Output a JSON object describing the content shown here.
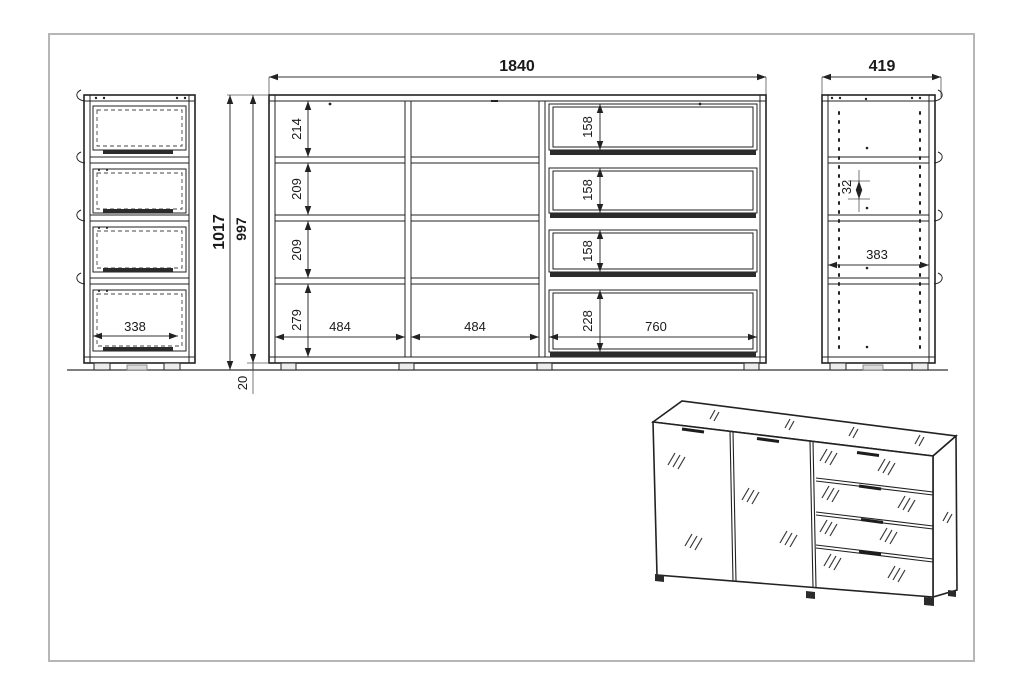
{
  "dimensions": {
    "total_width": "1840",
    "total_depth": "419",
    "total_height": "1017",
    "body_height": "997",
    "plinth_height": "20",
    "row_1": "214",
    "row_2": "209",
    "row_3": "209",
    "row_4": "279",
    "drawer_1": "158",
    "drawer_2": "158",
    "drawer_3": "158",
    "drawer_4": "228",
    "bay_left": "484",
    "bay_center": "484",
    "bay_right": "760",
    "left_inner_width": "338",
    "right_inner_width": "383",
    "hole_pitch": "32"
  }
}
